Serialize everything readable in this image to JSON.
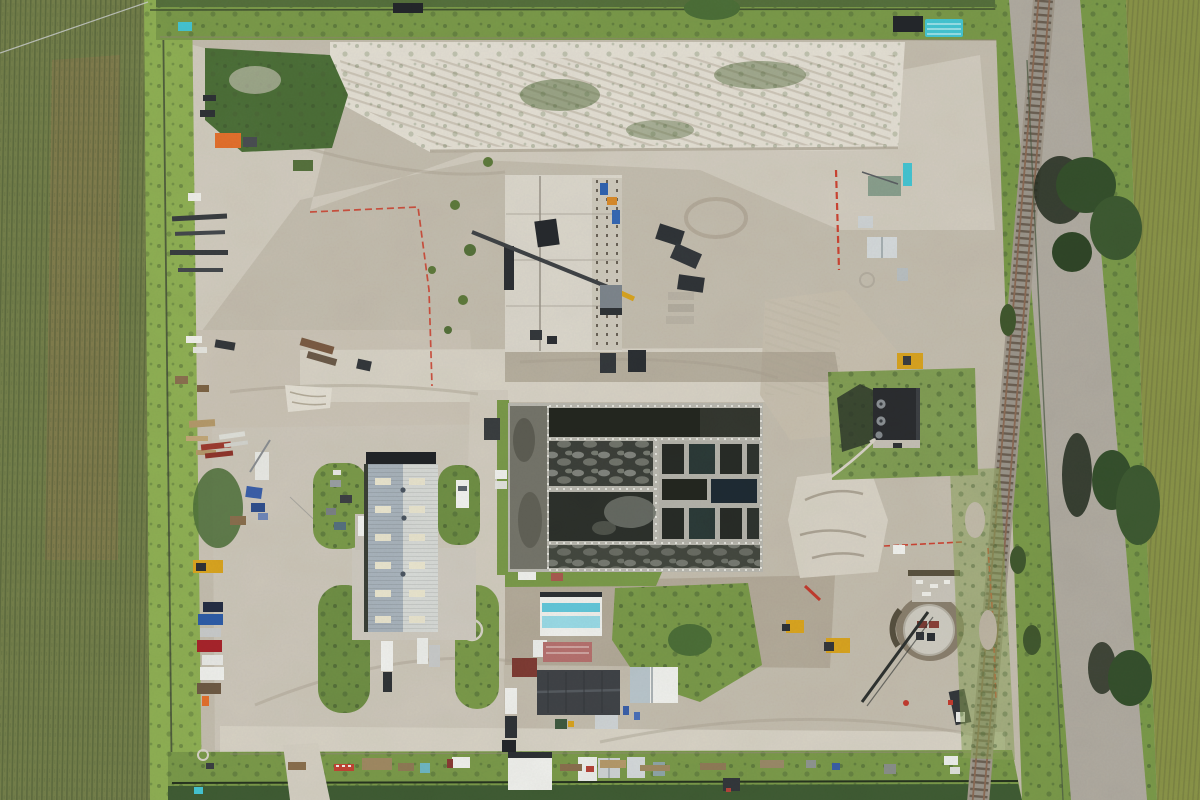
{
  "scene": {
    "type": "aerial-drone-photo",
    "subject": "wastewater treatment plant construction site",
    "surroundings": {
      "west": "corn field with dry brown patch and drainage ditch",
      "east": "railroad track with gravel ballast, tree line and corn field",
      "north": "grass berm and perimeter fence",
      "south": "grass strip with material laydown and perimeter fence"
    },
    "landmarks": [
      "soil stockpile berm",
      "concrete foundation under construction with crawler crane",
      "aeration basin with multiple water cells",
      "metal roof maintenance building with grass islands and parked trucks",
      "dark flat-roof blower building with roof vents",
      "circular concrete tank under construction",
      "support buildings cluster",
      "parked vehicle row",
      "material laydown yard",
      "erosion control silt fence (red)"
    ]
  },
  "colors": {
    "base": "#c4bdaf",
    "sandLight": "#d8d3c6",
    "sandBright": "#e4e0d5",
    "dirtDark": "#a89f8e",
    "dirtBrown": "#b3aa99",
    "gravelPad": "#cdc7ba",
    "cornField": "#74804b",
    "cornRow": "#4f5c36",
    "cornDry": "#8d7a4f",
    "cornEast": "#8a9448",
    "ditchGrass": "#8fb054",
    "grassVerge": "#7a9a4a",
    "grassDark": "#4c6f38",
    "tree": "#35502c",
    "treeShadow": "#232d1e",
    "ballast": "#b0aba1",
    "tieBrown": "#6b5f52",
    "railBrown": "#8b6b55",
    "waterDark": "#2c302b",
    "waterBlack": "#23261f",
    "waterBlue": "#1e2a33",
    "foamGray": "#94968e",
    "sludge": "#75756b",
    "concrete": "#b9b8b0",
    "concreteBright": "#dcd8cd",
    "railingWhite": "#e8e8e2",
    "roofBlue": "#a9b4bd",
    "roofWhite": "#d8dbd8",
    "skylight": "#e9e5cf",
    "shadowDark": "#202327",
    "roofBlack": "#2a2c2f",
    "roofCharcoal": "#3f4347",
    "blueStripe": "#62c8dc",
    "redTrailer": "#b5706e",
    "maroonShed": "#7e3b33",
    "whitePaint": "#f0f1ee",
    "shedGray": "#cfd4d6",
    "greenRoof": "#8aa08e",
    "tealPipe": "#45c6d4",
    "orangeTarp": "#e4702c",
    "blueTarp": "#3a5fa8",
    "redFence": "#cc4432",
    "machineYellow": "#d9a41f",
    "machineDark": "#3a3e42",
    "carNavy": "#232c44",
    "carBlue": "#2d5ca8",
    "carRed": "#a8232a",
    "carSilver": "#c9cbcb",
    "steelRust": "#7a5b43",
    "lumberTan": "#b59a6b",
    "redSteel": "#9e3b30",
    "woodBrown": "#8a6f4e"
  }
}
